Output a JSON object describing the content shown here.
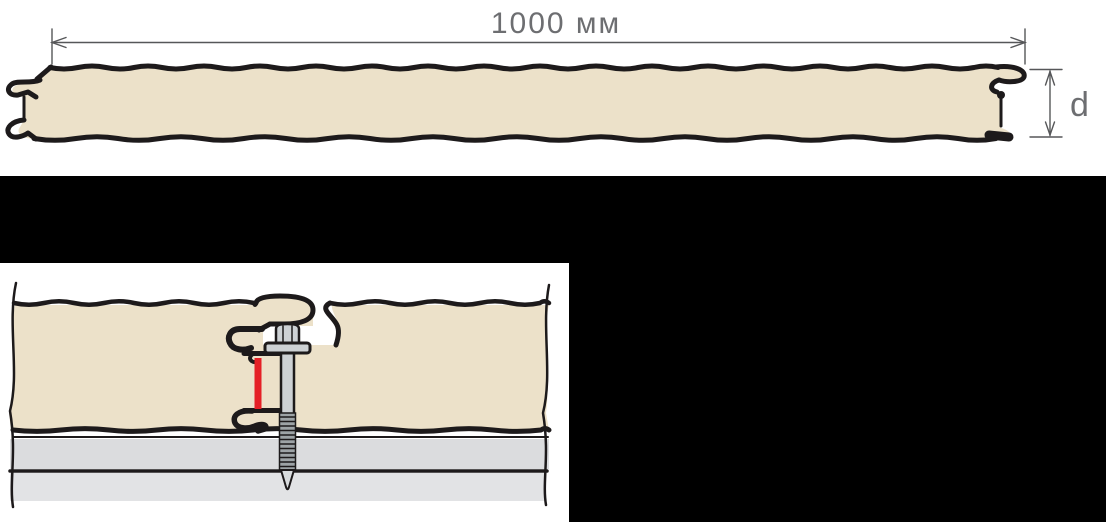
{
  "figure": {
    "width_label": "1000 мм",
    "thickness_label": "d"
  },
  "colors": {
    "background_black": "#000000",
    "sheet_white": "#ffffff",
    "panel_fill": "#ece1c9",
    "outline": "#1d1a1b",
    "dim_line": "#565759",
    "dim_text": "#6d6e71",
    "metal": "#cdd1d4",
    "thread": "#9da3a6",
    "tip": "#d9dcde",
    "substrate_1": "#dbdcde",
    "substrate_2": "#e2e3e5",
    "accent_red": "#e52026"
  }
}
